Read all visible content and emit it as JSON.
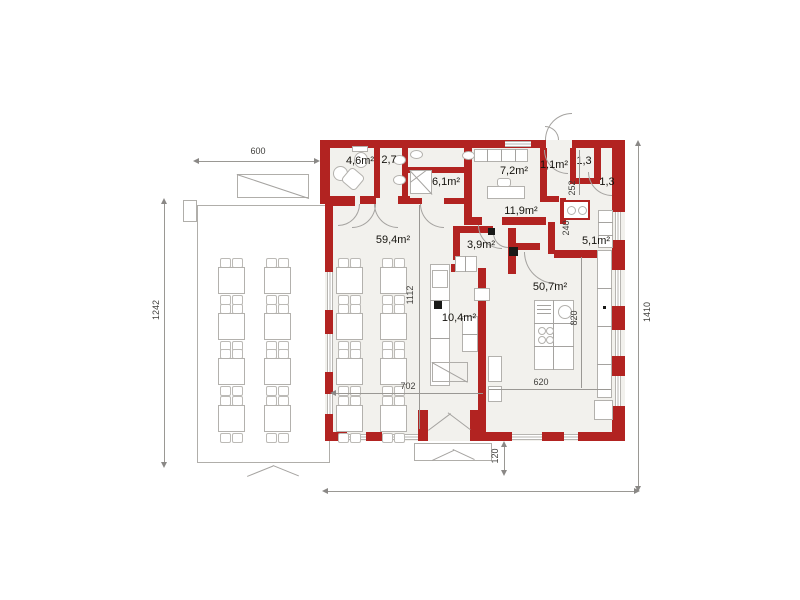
{
  "plan_title": "restaurant-floor-plan",
  "colors": {
    "wall": "#b22321",
    "room_fill": "#f2f1ed",
    "fixture_line": "#b3b1ad",
    "dimension_line": "#9a9894",
    "dimension_text": "#3f3e3b",
    "label_text": "#15130e"
  },
  "rooms": [
    {
      "name": "wc",
      "area_label": "4,6m²"
    },
    {
      "name": "corridor-small",
      "area_label": "2,7"
    },
    {
      "name": "shower-room",
      "area_label": "6,1m²"
    },
    {
      "name": "office",
      "area_label": "7,2m²"
    },
    {
      "name": "vestibule",
      "area_label": "1,1m²"
    },
    {
      "name": "closet-left",
      "area_label": "1,3"
    },
    {
      "name": "closet-right",
      "area_label": "1,3"
    },
    {
      "name": "hall",
      "area_label": "11,9m²"
    },
    {
      "name": "storage",
      "area_label": "3,9m²"
    },
    {
      "name": "pantry",
      "area_label": "5,1m²"
    },
    {
      "name": "dining-room",
      "area_label": "59,4m²"
    },
    {
      "name": "kitchen",
      "area_label": "50,7m²"
    },
    {
      "name": "servery",
      "area_label": "10,4m²"
    }
  ],
  "dimensions": {
    "top_width": "600",
    "left_height": "1242",
    "right_height": "1410",
    "dining_inner_height": "1112",
    "dining_inner_width": "702",
    "kitchen_inner_width": "620",
    "island_offset": "820",
    "closet_depth": "252",
    "stove_nook_width": "240",
    "door_offset": "120"
  }
}
